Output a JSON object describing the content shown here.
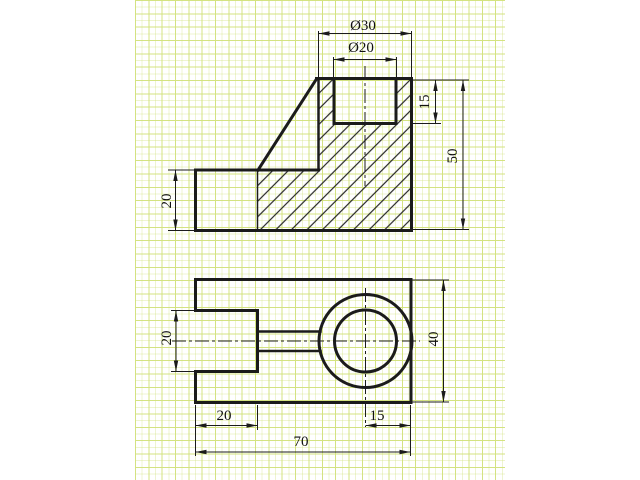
{
  "background_color": "#ffffff",
  "grid_color": "#d6e487",
  "line_color": "#1b1b1b",
  "dims": {
    "front": {
      "outer_diameter": "Ø30",
      "inner_diameter": "Ø20",
      "hole_depth": "15",
      "total_height": "50",
      "base_height": "20"
    },
    "top": {
      "slot_width": "20",
      "overall_depth": "40",
      "slot_length": "20",
      "center_to_edge": "15",
      "overall_width": "70"
    }
  }
}
